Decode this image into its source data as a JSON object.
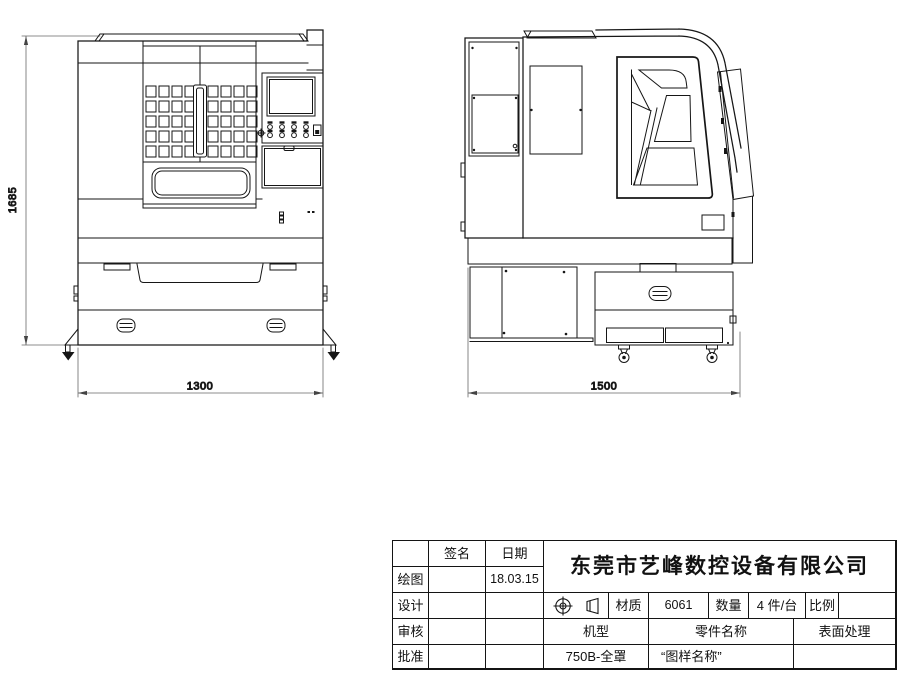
{
  "dimensions": {
    "front_height": "1685",
    "front_width": "1300",
    "side_width": "1500"
  },
  "title_block": {
    "company": "东莞市艺峰数控设备有限公司",
    "signature_header": "签名",
    "date_header": "日期",
    "approval_rows": [
      {
        "label": "绘图",
        "signature": "",
        "date": "18.03.15"
      },
      {
        "label": "设计",
        "signature": "",
        "date": ""
      },
      {
        "label": "审核",
        "signature": "",
        "date": ""
      },
      {
        "label": "批准",
        "signature": "",
        "date": ""
      }
    ],
    "material_label": "材质",
    "material_value": "6061",
    "quantity_label": "数量",
    "quantity_value": "4 件/台",
    "scale_label": "比例",
    "scale_value": "",
    "model_label": "机型",
    "model_value": "750B-全罩",
    "part_name_label": "零件名称",
    "part_name_value": "“图样名称”",
    "surface_label": "表面处理",
    "surface_value": "",
    "projection_symbol": "first-angle-projection-icon"
  }
}
